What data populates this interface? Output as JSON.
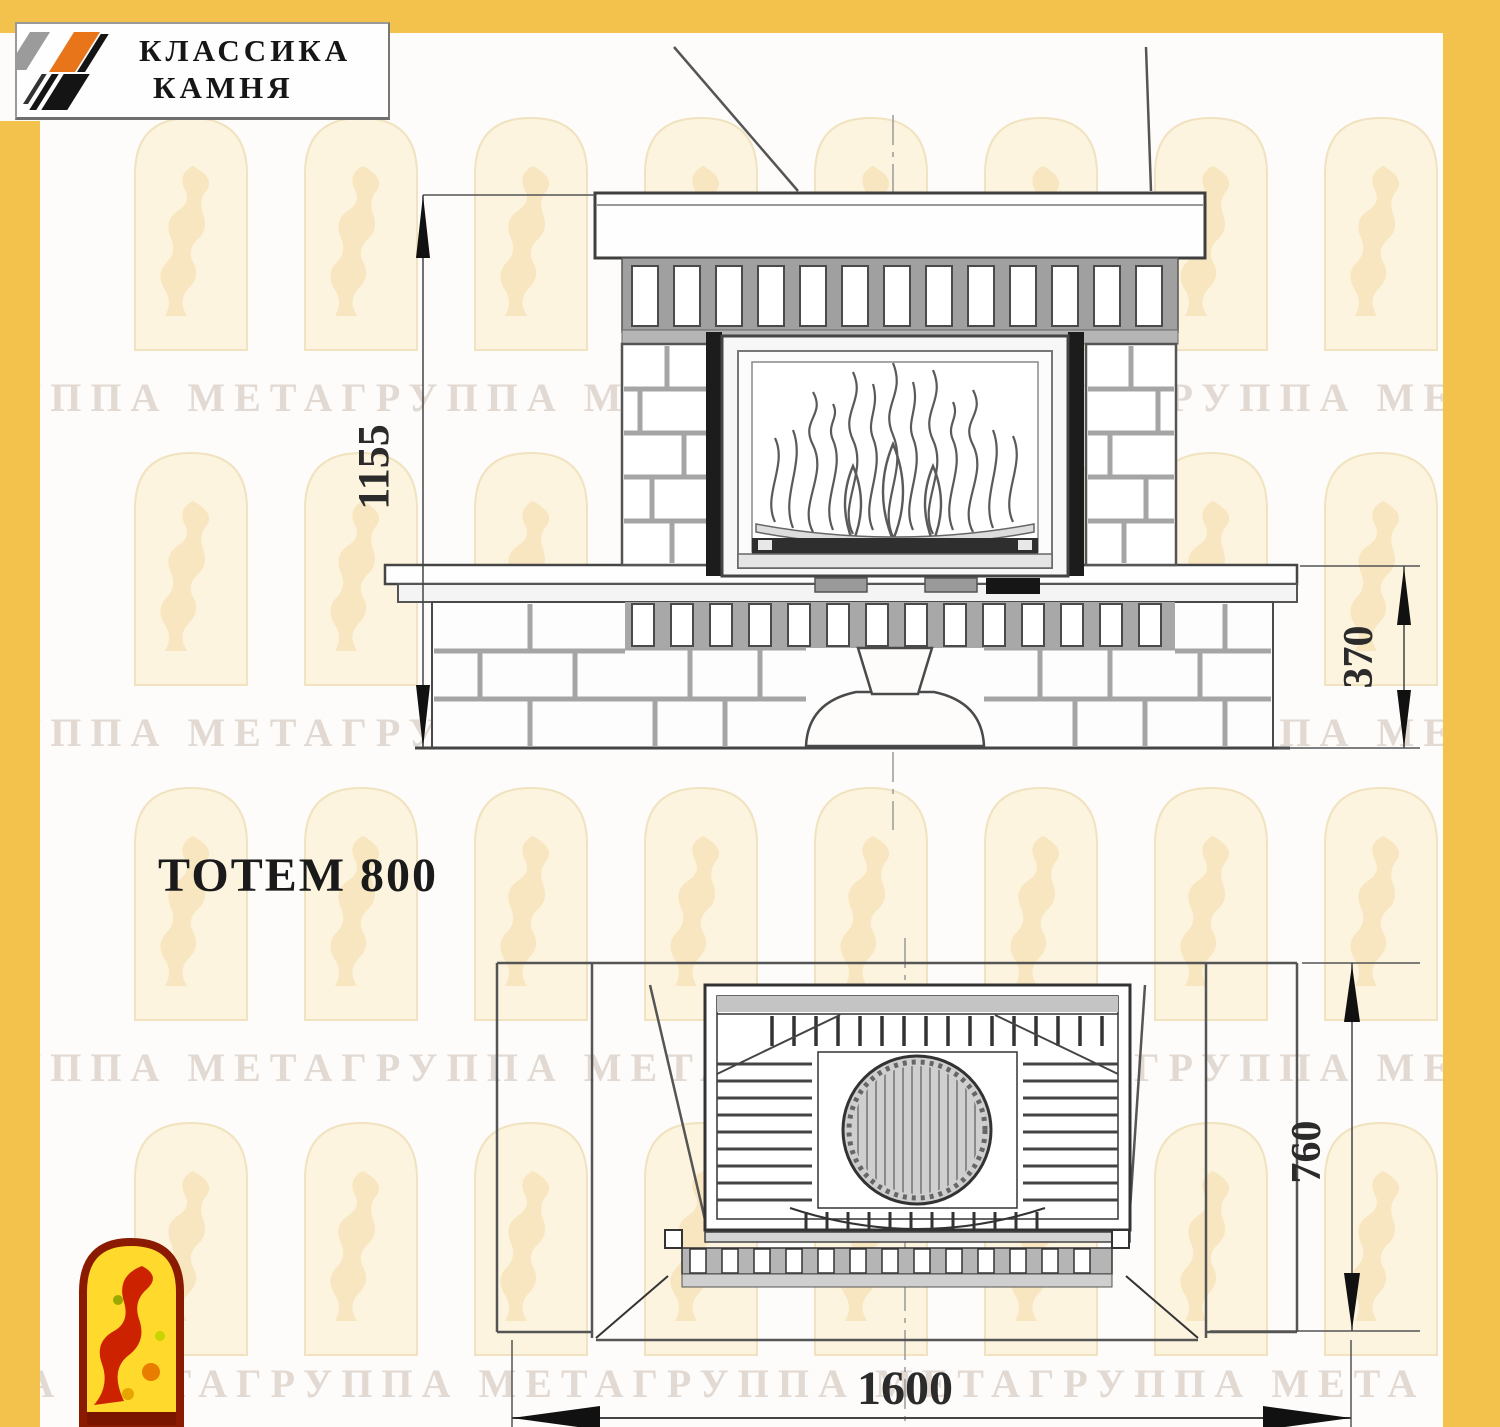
{
  "page": {
    "frame_color": "#F2C24D",
    "paper_color": "#FDFCFA"
  },
  "header_logo": {
    "line1": "КЛАССИКА",
    "line2": "КАМНЯ",
    "stripe_gray": "#9B9B9B",
    "stripe_orange": "#E8751A",
    "stripe_black": "#141414"
  },
  "title": "ТОТЕМ 800",
  "front_view": {
    "height_dim": "1155",
    "bench_height_dim": "370"
  },
  "plan_view": {
    "width_dim": "1600",
    "depth_dim": "760"
  },
  "watermark": {
    "rows": [
      "ГРУППА МЕТАГРУППА МЕТАГРУППА МЕТАГРУППА МЕТА",
      "ГРУППА МЕТАГРУППА МЕТАГРУППА МЕТАГРУППА МЕТА",
      "ГРУППА МЕТАГРУППА МЕТАГРУППА МЕТАГРУППА МЕТА",
      "ППА МЕТАГРУППА МЕТАГРУППА МЕТАГРУППА МЕТА МЕТАГРУППА"
    ]
  }
}
